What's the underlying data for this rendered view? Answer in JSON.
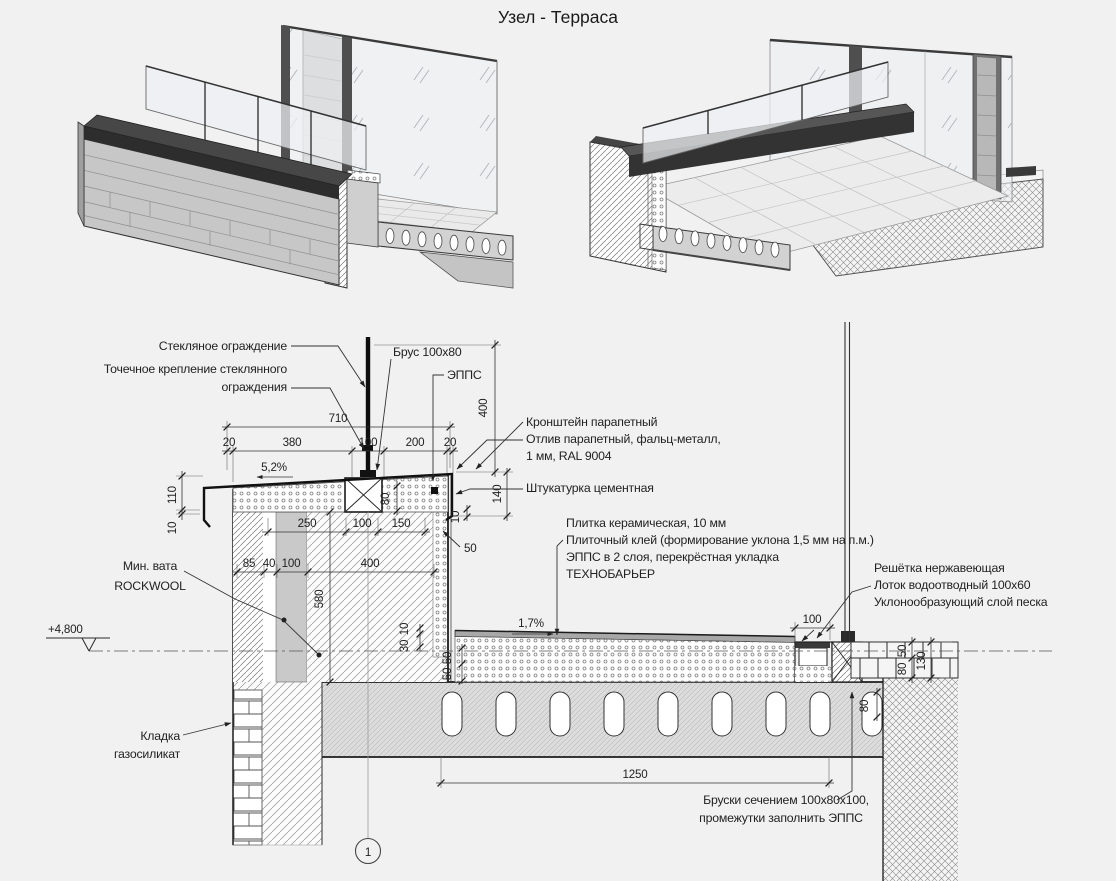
{
  "title": "Узел - Терраса",
  "colors": {
    "background": "#f1f1f2",
    "line": "#1f1f1f",
    "coping": "#3d3d3d",
    "glass": "#edeff1",
    "slab": "#d9d9d9"
  },
  "annotations": {
    "glass_railing": "Стекляное ограждение",
    "point_fix_1": "Точечное крепление стеклянного",
    "point_fix_2": "ограждения",
    "beam": "Брус 100х80",
    "epps": "ЭППС",
    "bracket": "Кронштейн парапетный",
    "flashing_1": "Отлив парапетный, фальц-металл,",
    "flashing_2": "1 мм, RAL 9004",
    "plaster": "Штукатурка цементная",
    "tile": "Плитка керамическая, 10 мм",
    "tile_glue": "Плиточный клей (формирование уклона 1,5 мм на п.м.)",
    "epps_2layers": "ЭППС в 2 слоя, перекрёстная укладка",
    "technobar": "ТЕХНОБАРЬЕР",
    "grate": "Решётка нержавеющая",
    "gutter": "Лоток водоотводный 100х60",
    "sand": "Уклонообразующий слой песка",
    "minwool_1": "Мин. вата",
    "minwool_2": "ROCKWOOL",
    "masonry_1": "Кладка",
    "masonry_2": "газосиликат",
    "bars_1": "Бруски сечением 100х80х100,",
    "bars_2": "промежутки заполнить ЭППС"
  },
  "level": {
    "value": "+4,800"
  },
  "slopes": {
    "parapet": "5,2%",
    "floor": "1,7%"
  },
  "marker": {
    "number": "1"
  },
  "dims": {
    "d710": "710",
    "d20a": "20",
    "d380": "380",
    "d100a": "100",
    "d200": "200",
    "d20b": "20",
    "d400": "400",
    "d110": "110",
    "d10a": "10",
    "d80a": "80",
    "d140": "140",
    "d10b": "10",
    "d250": "250",
    "d100b": "100",
    "d150": "150",
    "d50lead": "50",
    "d85": "85",
    "d40": "40",
    "d100c": "100",
    "d400b": "400",
    "d580": "580",
    "d10c": "10",
    "d30": "30",
    "d50a": "50",
    "d50b": "50",
    "d100d": "100",
    "d50c": "50",
    "d80b": "80",
    "d130": "130",
    "d80c": "80",
    "d1250": "1250"
  }
}
